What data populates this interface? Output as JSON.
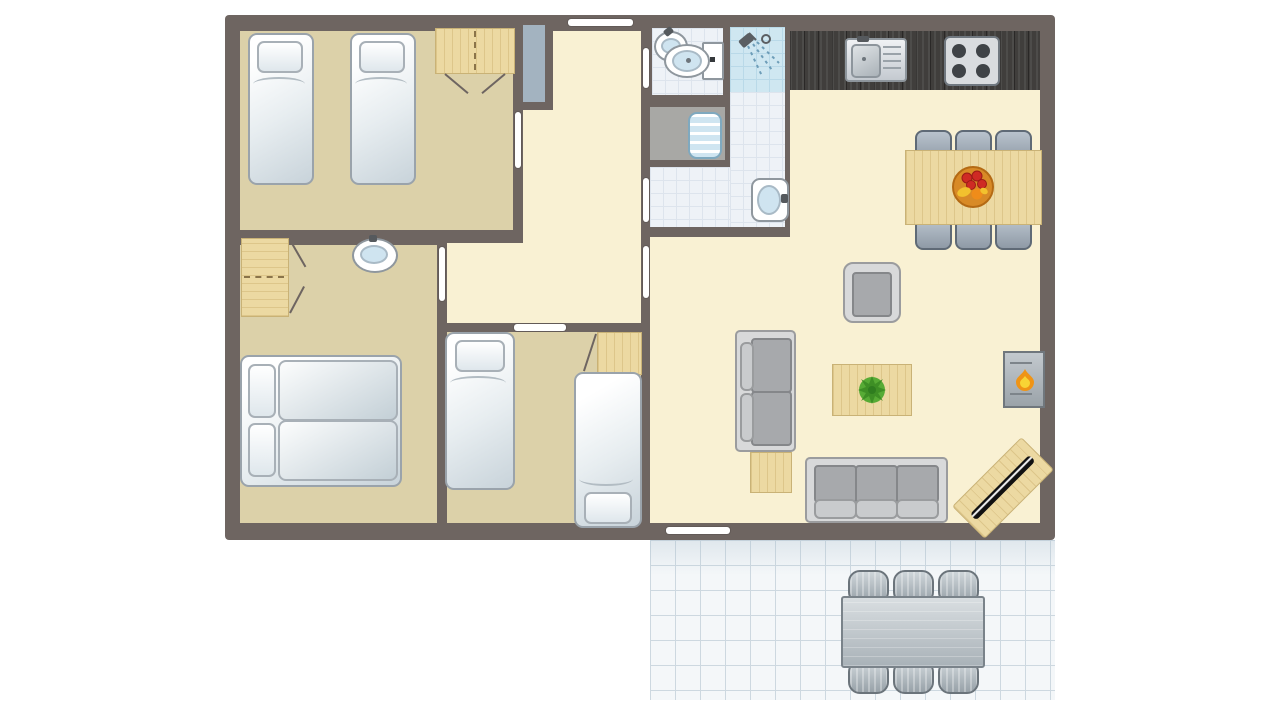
{
  "meta": {
    "type": "floor-plan",
    "description": "Top-down floor plan of a holiday home with three bedrooms, hallway, bathroom with separate toilet and shower, open kitchen with living-dining room, and an outdoor tiled terrace with garden furniture"
  },
  "palette": {
    "wall": "#6e6561",
    "floor-bedroom": "#dcd1a9",
    "floor-hall": "#f9f1d3",
    "floor-tile": "#eef2f7",
    "tile-grid": "#dde4ed",
    "floor-shower": "#cfe7f1",
    "shower-grid": "#b9d9e8",
    "floor-utility": "#a8a8a5",
    "closet": "#a3b3c0",
    "wood": "#ecd9a2",
    "wood-border": "#c9b276",
    "counter": "#403e3c",
    "bed-border": "#9aa3ab",
    "sofa-frame": "#d8d9da",
    "sofa-cushion": "#a7a9ac",
    "chair-blue": "#9fadbb",
    "deck-floor": "#f4f7f9",
    "deck-grid": "#cdd8e0",
    "outdoor-gray": "#aeb7bd",
    "door-mark": "#ffffff"
  },
  "rooms": [
    {
      "name": "bedroom-1",
      "furniture": [
        "single-bed",
        "single-bed",
        "wardrobe"
      ]
    },
    {
      "name": "bedroom-2",
      "furniture": [
        "wardrobe",
        "washbasin",
        "double-bed"
      ]
    },
    {
      "name": "bedroom-3",
      "furniture": [
        "single-bed",
        "single-bed",
        "wardrobe"
      ]
    },
    {
      "name": "hallway",
      "furniture": [
        "storage-closet"
      ]
    },
    {
      "name": "toilet-room",
      "furniture": [
        "corner-washbasin",
        "toilet"
      ]
    },
    {
      "name": "shower-cabin",
      "furniture": [
        "shower-head"
      ]
    },
    {
      "name": "utility-closet",
      "furniture": [
        "radiator-appliance"
      ]
    },
    {
      "name": "bathroom",
      "furniture": [
        "washbasin"
      ]
    },
    {
      "name": "kitchen",
      "furniture": [
        "counter",
        "kitchen-sink",
        "hob-4-burners"
      ]
    },
    {
      "name": "living-dining-room",
      "furniture": [
        "dining-table",
        "dining-chair x6",
        "fruit-bowl",
        "armchair",
        "two-seat-sofa",
        "three-seat-sofa",
        "coffee-table",
        "plant",
        "side-table",
        "fireplace",
        "tv-cabinet"
      ]
    },
    {
      "name": "terrace",
      "furniture": [
        "garden-table",
        "garden-chair x6"
      ]
    }
  ],
  "doors": [
    "front-door",
    "bedroom-1-door",
    "bedroom-2-door",
    "bedroom-3-door",
    "living-room-door",
    "toilet-door",
    "bathroom-door",
    "terrace-door"
  ]
}
